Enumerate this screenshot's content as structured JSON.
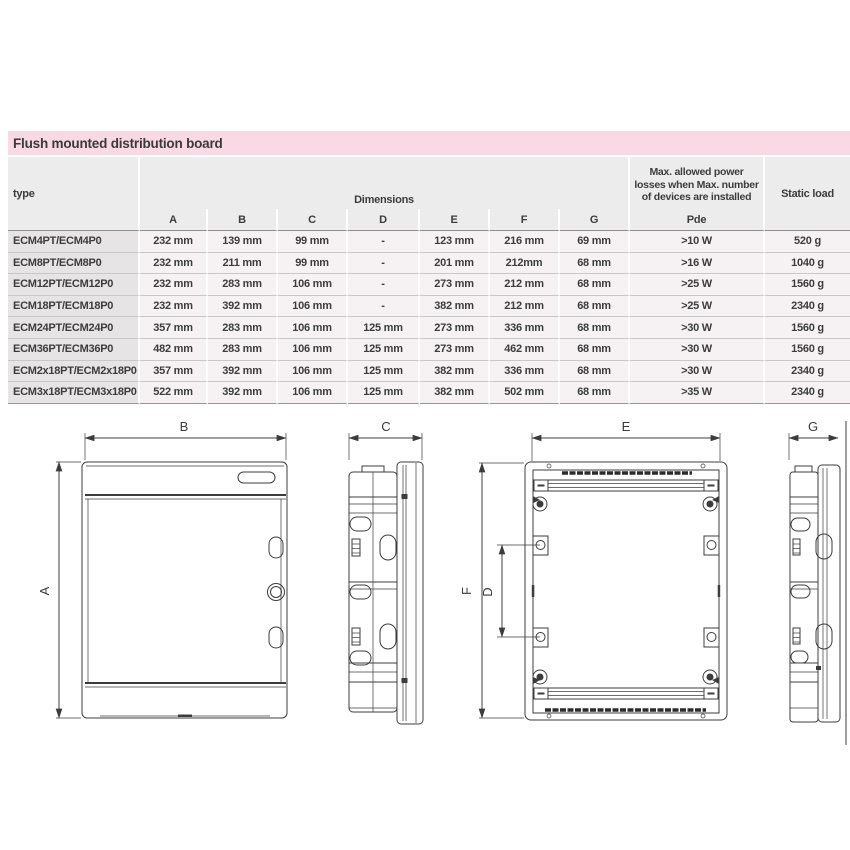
{
  "page": {
    "title": "Flush mounted distribution board"
  },
  "colors": {
    "title_bg": "#f9d9e4",
    "header_bg": "#ececec",
    "type_cell_bg": "#e7e4e5",
    "data_cell_bg": "#f6f2f3"
  },
  "table": {
    "headers": {
      "type": "type",
      "dimensions": "Dimensions",
      "cols": [
        "A",
        "B",
        "C",
        "D",
        "E",
        "F",
        "G"
      ],
      "power_line1": "Max. allowed power",
      "power_line2": "losses when Max. number",
      "power_line3": "of devices are installed",
      "power_symbol": "Pde",
      "static_load": "Static load"
    },
    "rows": [
      {
        "type": "ECM4PT/ECM4P0",
        "a": "232 mm",
        "b": "139 mm",
        "c": "99 mm",
        "d": "-",
        "e": "123 mm",
        "f": "216 mm",
        "g": "69 mm",
        "pde": ">10 W",
        "load": "520 g"
      },
      {
        "type": "ECM8PT/ECM8P0",
        "a": "232 mm",
        "b": "211 mm",
        "c": "99 mm",
        "d": "-",
        "e": "201 mm",
        "f": "212mm",
        "g": "68 mm",
        "pde": ">16 W",
        "load": "1040 g"
      },
      {
        "type": "ECM12PT/ECM12P0",
        "a": "232 mm",
        "b": "283 mm",
        "c": "106 mm",
        "d": "-",
        "e": "273 mm",
        "f": "212 mm",
        "g": "68 mm",
        "pde": ">25 W",
        "load": "1560 g"
      },
      {
        "type": "ECM18PT/ECM18P0",
        "a": "232 mm",
        "b": "392 mm",
        "c": "106 mm",
        "d": "-",
        "e": "382 mm",
        "f": "212 mm",
        "g": "68 mm",
        "pde": ">25 W",
        "load": "2340 g"
      },
      {
        "type": "ECM24PT/ECM24P0",
        "a": "357 mm",
        "b": "283 mm",
        "c": "106 mm",
        "d": "125 mm",
        "e": "273 mm",
        "f": "336 mm",
        "g": "68 mm",
        "pde": ">30 W",
        "load": "1560 g"
      },
      {
        "type": "ECM36PT/ECM36P0",
        "a": "482 mm",
        "b": "283 mm",
        "c": "106 mm",
        "d": "125 mm",
        "e": "273 mm",
        "f": "462 mm",
        "g": "68 mm",
        "pde": ">30 W",
        "load": "1560 g"
      },
      {
        "type": "ECM2x18PT/ECM2x18P0",
        "a": "357 mm",
        "b": "392 mm",
        "c": "106 mm",
        "d": "125 mm",
        "e": "382 mm",
        "f": "336 mm",
        "g": "68 mm",
        "pde": ">30 W",
        "load": "2340 g"
      },
      {
        "type": "ECM3x18PT/ECM3x18P0",
        "a": "522 mm",
        "b": "392 mm",
        "c": "106 mm",
        "d": "125 mm",
        "e": "382 mm",
        "f": "502 mm",
        "g": "68 mm",
        "pde": ">35 W",
        "load": "2340 g"
      }
    ]
  },
  "drawings": {
    "labels": {
      "a": "A",
      "b": "B",
      "c": "C",
      "d": "D",
      "e": "E",
      "f": "F",
      "g": "G"
    }
  }
}
